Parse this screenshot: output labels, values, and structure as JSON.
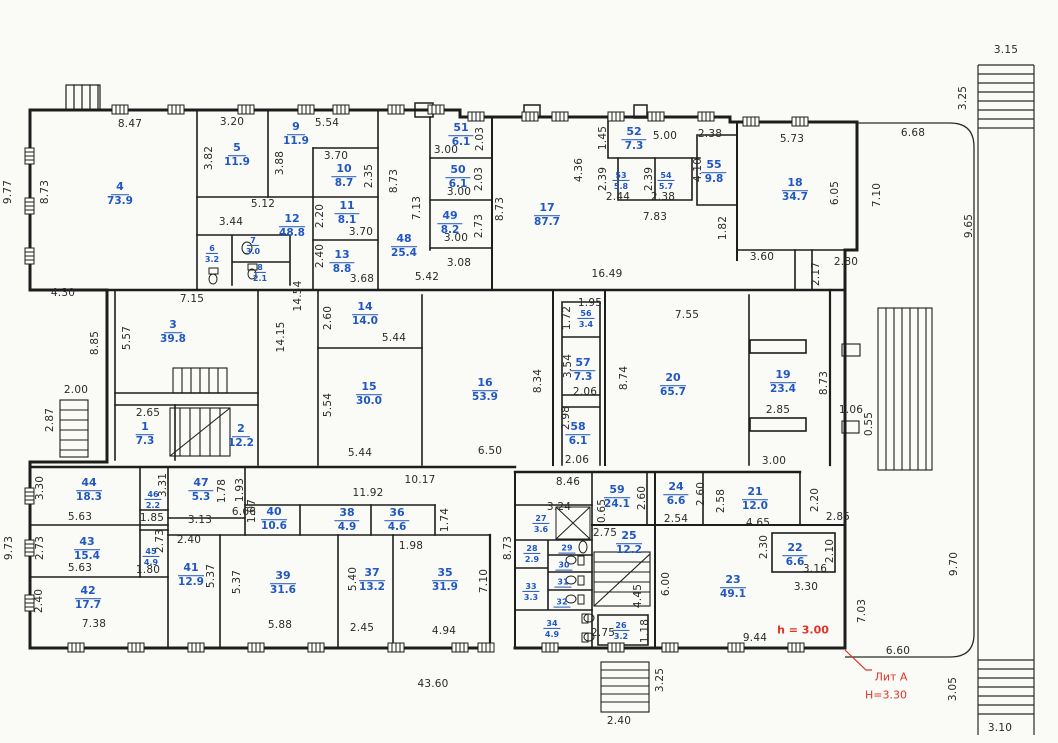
{
  "meta": {
    "kind": "floor-plan-scan",
    "width": 1058,
    "height": 743
  },
  "colors": {
    "room_label": "#2057c0",
    "dimension": "#2a2a2a",
    "annotation_red": "#e03427",
    "wall": "#1d1d1d",
    "paper": "#fafaf7"
  },
  "red_notes": [
    {
      "text": "h = 3.00",
      "x": 803,
      "y": 630,
      "bold": true
    },
    {
      "text": "Лит А",
      "x": 891,
      "y": 677,
      "bold": false
    },
    {
      "text": "Н=3.30",
      "x": 886,
      "y": 695,
      "bold": false
    }
  ],
  "rooms": [
    {
      "n": "4",
      "a": "73.9",
      "x": 120,
      "y": 192
    },
    {
      "n": "5",
      "a": "11.9",
      "x": 237,
      "y": 153
    },
    {
      "n": "9",
      "a": "11.9",
      "x": 296,
      "y": 132
    },
    {
      "n": "10",
      "a": "8.7",
      "x": 344,
      "y": 174
    },
    {
      "n": "11",
      "a": "8.1",
      "x": 347,
      "y": 211
    },
    {
      "n": "12",
      "a": "48.8",
      "x": 292,
      "y": 224
    },
    {
      "n": "6",
      "a": "3.2",
      "x": 212,
      "y": 251,
      "s": 1
    },
    {
      "n": "7",
      "a": "3.0",
      "x": 253,
      "y": 243,
      "s": 1
    },
    {
      "n": "8",
      "a": "2.1",
      "x": 260,
      "y": 270,
      "s": 1
    },
    {
      "n": "13",
      "a": "8.8",
      "x": 342,
      "y": 260
    },
    {
      "n": "48",
      "a": "25.4",
      "x": 404,
      "y": 244
    },
    {
      "n": "51",
      "a": "6.1",
      "x": 461,
      "y": 133
    },
    {
      "n": "50",
      "a": "6.1",
      "x": 458,
      "y": 175
    },
    {
      "n": "49",
      "a": "8.2",
      "x": 450,
      "y": 221
    },
    {
      "n": "17",
      "a": "87.7",
      "x": 547,
      "y": 213
    },
    {
      "n": "52",
      "a": "7.3",
      "x": 634,
      "y": 137
    },
    {
      "n": "53",
      "a": "5.8",
      "x": 621,
      "y": 178,
      "s": 1
    },
    {
      "n": "54",
      "a": "5.7",
      "x": 666,
      "y": 178,
      "s": 1
    },
    {
      "n": "55",
      "a": "9.8",
      "x": 714,
      "y": 170
    },
    {
      "n": "18",
      "a": "34.7",
      "x": 795,
      "y": 188
    },
    {
      "n": "3",
      "a": "39.8",
      "x": 173,
      "y": 330
    },
    {
      "n": "1",
      "a": "7.3",
      "x": 145,
      "y": 432
    },
    {
      "n": "2",
      "a": "12.2",
      "x": 241,
      "y": 434
    },
    {
      "n": "14",
      "a": "14.0",
      "x": 365,
      "y": 312
    },
    {
      "n": "15",
      "a": "30.0",
      "x": 369,
      "y": 392
    },
    {
      "n": "16",
      "a": "53.9",
      "x": 485,
      "y": 388
    },
    {
      "n": "56",
      "a": "3.4",
      "x": 586,
      "y": 316,
      "s": 1
    },
    {
      "n": "57",
      "a": "7.3",
      "x": 583,
      "y": 368
    },
    {
      "n": "58",
      "a": "6.1",
      "x": 578,
      "y": 432
    },
    {
      "n": "20",
      "a": "65.7",
      "x": 673,
      "y": 383
    },
    {
      "n": "19",
      "a": "23.4",
      "x": 783,
      "y": 380
    },
    {
      "n": "44",
      "a": "18.3",
      "x": 89,
      "y": 488
    },
    {
      "n": "46",
      "a": "2.2",
      "x": 153,
      "y": 497,
      "s": 1
    },
    {
      "n": "47",
      "a": "5.3",
      "x": 201,
      "y": 488
    },
    {
      "n": "43",
      "a": "15.4",
      "x": 87,
      "y": 547
    },
    {
      "n": "45",
      "a": "4.9",
      "x": 151,
      "y": 554,
      "s": 1
    },
    {
      "n": "42",
      "a": "17.7",
      "x": 88,
      "y": 596
    },
    {
      "n": "41",
      "a": "12.9",
      "x": 191,
      "y": 573
    },
    {
      "n": "40",
      "a": "10.6",
      "x": 274,
      "y": 517
    },
    {
      "n": "38",
      "a": "4.9",
      "x": 347,
      "y": 518
    },
    {
      "n": "36",
      "a": "4.6",
      "x": 397,
      "y": 518
    },
    {
      "n": "39",
      "a": "31.6",
      "x": 283,
      "y": 581
    },
    {
      "n": "37",
      "a": "13.2",
      "x": 372,
      "y": 578
    },
    {
      "n": "35",
      "a": "31.9",
      "x": 445,
      "y": 578
    },
    {
      "n": "27",
      "a": "3.6",
      "x": 541,
      "y": 521,
      "s": 1
    },
    {
      "n": "28",
      "a": "2.9",
      "x": 532,
      "y": 551,
      "s": 1
    },
    {
      "n": "29",
      "a": "",
      "x": 567,
      "y": 546,
      "s": 1
    },
    {
      "n": "30",
      "a": "",
      "x": 564,
      "y": 563,
      "s": 1
    },
    {
      "n": "33",
      "a": "3.3",
      "x": 531,
      "y": 589,
      "s": 1
    },
    {
      "n": "31",
      "a": "",
      "x": 563,
      "y": 580,
      "s": 1
    },
    {
      "n": "32",
      "a": "",
      "x": 562,
      "y": 600,
      "s": 1
    },
    {
      "n": "34",
      "a": "4.9",
      "x": 552,
      "y": 626,
      "s": 1
    },
    {
      "n": "26",
      "a": "3.2",
      "x": 621,
      "y": 628,
      "s": 1
    },
    {
      "n": "25",
      "a": "12.2",
      "x": 629,
      "y": 541
    },
    {
      "n": "59",
      "a": "24.1",
      "x": 617,
      "y": 495
    },
    {
      "n": "24",
      "a": "6.6",
      "x": 676,
      "y": 492
    },
    {
      "n": "21",
      "a": "12.0",
      "x": 755,
      "y": 497
    },
    {
      "n": "22",
      "a": "6.6",
      "x": 795,
      "y": 553
    },
    {
      "n": "23",
      "a": "49.1",
      "x": 733,
      "y": 585
    }
  ],
  "dims": [
    {
      "t": "8.47",
      "x": 130,
      "y": 124
    },
    {
      "t": "3.20",
      "x": 232,
      "y": 122
    },
    {
      "t": "5.54",
      "x": 327,
      "y": 123
    },
    {
      "t": "3.82",
      "x": 209,
      "y": 158,
      "r": 1
    },
    {
      "t": "3.88",
      "x": 280,
      "y": 163,
      "r": 1
    },
    {
      "t": "3.70",
      "x": 336,
      "y": 156
    },
    {
      "t": "2.35",
      "x": 369,
      "y": 176,
      "r": 1
    },
    {
      "t": "5.12",
      "x": 263,
      "y": 204
    },
    {
      "t": "3.44",
      "x": 231,
      "y": 222
    },
    {
      "t": "2.20",
      "x": 320,
      "y": 216,
      "r": 1
    },
    {
      "t": "3.70",
      "x": 361,
      "y": 232
    },
    {
      "t": "2.40",
      "x": 320,
      "y": 256,
      "r": 1
    },
    {
      "t": "3.68",
      "x": 362,
      "y": 279
    },
    {
      "t": "8.73",
      "x": 45,
      "y": 192,
      "r": 1
    },
    {
      "t": "9.77",
      "x": 8,
      "y": 192,
      "r": 1
    },
    {
      "t": "4.30",
      "x": 63,
      "y": 293
    },
    {
      "t": "7.15",
      "x": 192,
      "y": 299
    },
    {
      "t": "8.85",
      "x": 95,
      "y": 343,
      "r": 1
    },
    {
      "t": "5.57",
      "x": 127,
      "y": 338,
      "r": 1
    },
    {
      "t": "2.00",
      "x": 76,
      "y": 390
    },
    {
      "t": "2.87",
      "x": 50,
      "y": 420,
      "r": 1
    },
    {
      "t": "2.65",
      "x": 148,
      "y": 413
    },
    {
      "t": "14.54",
      "x": 298,
      "y": 296,
      "r": 1
    },
    {
      "t": "14.15",
      "x": 281,
      "y": 337,
      "r": 1
    },
    {
      "t": "8.73",
      "x": 394,
      "y": 181,
      "r": 1
    },
    {
      "t": "7.13",
      "x": 417,
      "y": 208,
      "r": 1
    },
    {
      "t": "3.00",
      "x": 446,
      "y": 150
    },
    {
      "t": "2.03",
      "x": 480,
      "y": 139,
      "r": 1
    },
    {
      "t": "3.00",
      "x": 459,
      "y": 192
    },
    {
      "t": "2.03",
      "x": 479,
      "y": 179,
      "r": 1
    },
    {
      "t": "2.73",
      "x": 479,
      "y": 226,
      "r": 1
    },
    {
      "t": "3.00",
      "x": 456,
      "y": 238
    },
    {
      "t": "3.08",
      "x": 459,
      "y": 263
    },
    {
      "t": "5.42",
      "x": 427,
      "y": 277
    },
    {
      "t": "8.73",
      "x": 500,
      "y": 209,
      "r": 1
    },
    {
      "t": "16.49",
      "x": 607,
      "y": 274
    },
    {
      "t": "4.36",
      "x": 579,
      "y": 170,
      "r": 1
    },
    {
      "t": "1.45",
      "x": 603,
      "y": 138,
      "r": 1
    },
    {
      "t": "5.00",
      "x": 665,
      "y": 136
    },
    {
      "t": "2.38",
      "x": 710,
      "y": 134
    },
    {
      "t": "2.39",
      "x": 603,
      "y": 179,
      "r": 1
    },
    {
      "t": "2.44",
      "x": 618,
      "y": 197
    },
    {
      "t": "2.39",
      "x": 649,
      "y": 179,
      "r": 1
    },
    {
      "t": "2.38",
      "x": 663,
      "y": 197
    },
    {
      "t": "7.83",
      "x": 655,
      "y": 217
    },
    {
      "t": "4.10",
      "x": 698,
      "y": 170,
      "r": 1
    },
    {
      "t": "5.73",
      "x": 792,
      "y": 139
    },
    {
      "t": "6.68",
      "x": 913,
      "y": 133
    },
    {
      "t": "6.05",
      "x": 835,
      "y": 193,
      "r": 1
    },
    {
      "t": "7.10",
      "x": 877,
      "y": 195,
      "r": 1
    },
    {
      "t": "1.82",
      "x": 723,
      "y": 228,
      "r": 1
    },
    {
      "t": "3.60",
      "x": 762,
      "y": 257
    },
    {
      "t": "2.80",
      "x": 846,
      "y": 262
    },
    {
      "t": "2.17",
      "x": 816,
      "y": 274,
      "r": 1
    },
    {
      "t": "9.65",
      "x": 969,
      "y": 226,
      "r": 1
    },
    {
      "t": "3.15",
      "x": 1006,
      "y": 50
    },
    {
      "t": "3.25",
      "x": 963,
      "y": 98,
      "r": 1
    },
    {
      "t": "2.60",
      "x": 328,
      "y": 318,
      "r": 1
    },
    {
      "t": "5.44",
      "x": 394,
      "y": 338
    },
    {
      "t": "5.54",
      "x": 328,
      "y": 405,
      "r": 1
    },
    {
      "t": "5.44",
      "x": 360,
      "y": 453
    },
    {
      "t": "6.50",
      "x": 490,
      "y": 451
    },
    {
      "t": "8.34",
      "x": 538,
      "y": 381,
      "r": 1
    },
    {
      "t": "1.95",
      "x": 590,
      "y": 303
    },
    {
      "t": "1.72",
      "x": 567,
      "y": 318,
      "r": 1
    },
    {
      "t": "3.54",
      "x": 568,
      "y": 366,
      "r": 1
    },
    {
      "t": "2.06",
      "x": 585,
      "y": 392
    },
    {
      "t": "2.98",
      "x": 566,
      "y": 418,
      "r": 1
    },
    {
      "t": "2.06",
      "x": 577,
      "y": 460
    },
    {
      "t": "10.17",
      "x": 420,
      "y": 480
    },
    {
      "t": "8.46",
      "x": 568,
      "y": 482
    },
    {
      "t": "7.55",
      "x": 687,
      "y": 315
    },
    {
      "t": "8.74",
      "x": 624,
      "y": 378,
      "r": 1
    },
    {
      "t": "8.73",
      "x": 824,
      "y": 383,
      "r": 1
    },
    {
      "t": "2.85",
      "x": 778,
      "y": 410
    },
    {
      "t": "3.00",
      "x": 774,
      "y": 461
    },
    {
      "t": "1.06",
      "x": 851,
      "y": 410
    },
    {
      "t": "0.55",
      "x": 869,
      "y": 424,
      "r": 1
    },
    {
      "t": "3.30",
      "x": 40,
      "y": 488,
      "r": 1
    },
    {
      "t": "5.63",
      "x": 80,
      "y": 517
    },
    {
      "t": "2.73",
      "x": 40,
      "y": 548,
      "r": 1
    },
    {
      "t": "5.63",
      "x": 80,
      "y": 568
    },
    {
      "t": "2.40",
      "x": 39,
      "y": 601,
      "r": 1
    },
    {
      "t": "7.38",
      "x": 94,
      "y": 624
    },
    {
      "t": "9.73",
      "x": 9,
      "y": 548,
      "r": 1
    },
    {
      "t": "1.85",
      "x": 152,
      "y": 518
    },
    {
      "t": "3.31",
      "x": 163,
      "y": 485,
      "r": 1
    },
    {
      "t": "2.73",
      "x": 160,
      "y": 541,
      "r": 1
    },
    {
      "t": "1.80",
      "x": 148,
      "y": 570
    },
    {
      "t": "3.13",
      "x": 200,
      "y": 520
    },
    {
      "t": "1.78",
      "x": 222,
      "y": 491,
      "r": 1
    },
    {
      "t": "1.93",
      "x": 240,
      "y": 490,
      "r": 1
    },
    {
      "t": "1.07",
      "x": 252,
      "y": 511,
      "r": 1
    },
    {
      "t": "2.40",
      "x": 189,
      "y": 540
    },
    {
      "t": "5.37",
      "x": 211,
      "y": 576,
      "r": 1
    },
    {
      "t": "5.37",
      "x": 237,
      "y": 582,
      "r": 1
    },
    {
      "t": "6.66",
      "x": 244,
      "y": 512
    },
    {
      "t": "11.92",
      "x": 368,
      "y": 493
    },
    {
      "t": "1.74",
      "x": 445,
      "y": 520,
      "r": 1
    },
    {
      "t": "1.98",
      "x": 411,
      "y": 546
    },
    {
      "t": "5.40",
      "x": 353,
      "y": 579,
      "r": 1
    },
    {
      "t": "2.45",
      "x": 362,
      "y": 628
    },
    {
      "t": "5.88",
      "x": 280,
      "y": 625
    },
    {
      "t": "4.94",
      "x": 444,
      "y": 631
    },
    {
      "t": "7.10",
      "x": 484,
      "y": 581,
      "r": 1
    },
    {
      "t": "8.73",
      "x": 508,
      "y": 548,
      "r": 1
    },
    {
      "t": "3.24",
      "x": 559,
      "y": 507
    },
    {
      "t": "0.65",
      "x": 602,
      "y": 511,
      "r": 1
    },
    {
      "t": "2.60",
      "x": 642,
      "y": 498,
      "r": 1
    },
    {
      "t": "2.60",
      "x": 701,
      "y": 494,
      "r": 1
    },
    {
      "t": "2.58",
      "x": 721,
      "y": 501,
      "r": 1
    },
    {
      "t": "2.54",
      "x": 676,
      "y": 519
    },
    {
      "t": "4.65",
      "x": 758,
      "y": 523
    },
    {
      "t": "2.20",
      "x": 815,
      "y": 500,
      "r": 1
    },
    {
      "t": "2.85",
      "x": 838,
      "y": 517
    },
    {
      "t": "2.75",
      "x": 605,
      "y": 533
    },
    {
      "t": "2.30",
      "x": 764,
      "y": 547,
      "r": 1
    },
    {
      "t": "2.10",
      "x": 830,
      "y": 551,
      "r": 1
    },
    {
      "t": "3.16",
      "x": 815,
      "y": 569
    },
    {
      "t": "3.30",
      "x": 806,
      "y": 587
    },
    {
      "t": "6.00",
      "x": 666,
      "y": 584,
      "r": 1
    },
    {
      "t": "4.45",
      "x": 638,
      "y": 596,
      "r": 1
    },
    {
      "t": "2.75",
      "x": 603,
      "y": 633
    },
    {
      "t": "1.18",
      "x": 645,
      "y": 631,
      "r": 1
    },
    {
      "t": "9.44",
      "x": 755,
      "y": 638
    },
    {
      "t": "7.03",
      "x": 862,
      "y": 611,
      "r": 1
    },
    {
      "t": "6.60",
      "x": 898,
      "y": 651
    },
    {
      "t": "9.70",
      "x": 954,
      "y": 564,
      "r": 1
    },
    {
      "t": "3.05",
      "x": 953,
      "y": 689,
      "r": 1
    },
    {
      "t": "3.10",
      "x": 1000,
      "y": 728
    },
    {
      "t": "43.60",
      "x": 433,
      "y": 684
    },
    {
      "t": "2.40",
      "x": 619,
      "y": 721
    },
    {
      "t": "3.25",
      "x": 660,
      "y": 680,
      "r": 1
    }
  ]
}
